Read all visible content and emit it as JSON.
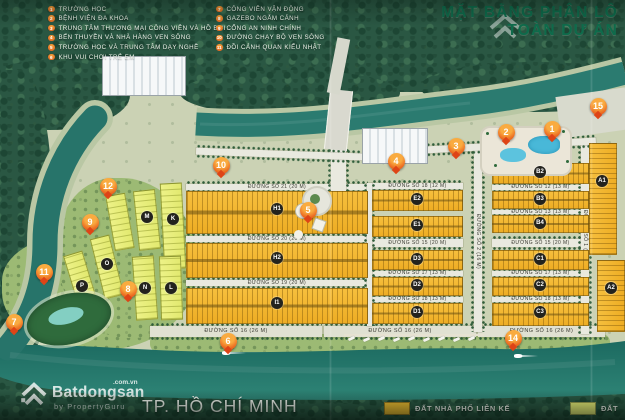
{
  "header": {
    "title_line1": "MẶT BẰNG PHÂN LÔ",
    "title_line2": "TOÀN DỰ ÁN"
  },
  "city_label": "TP. HỒ CHÍ MINH",
  "watermark": {
    "brand": "Batdongsan",
    "suffix": ".com.vn",
    "byline": "by PropertyGuru"
  },
  "legend_top": {
    "col1": [
      {
        "n": "1",
        "label": "TRƯỜNG HỌC"
      },
      {
        "n": "2",
        "label": "BỆNH VIỆN ĐA KHOA"
      },
      {
        "n": "3",
        "label": "TRUNG TÂM THƯƠNG MẠI CÔNG VIÊN VÀ HỒ BƠI"
      },
      {
        "n": "4",
        "label": "BẾN THUYỀN VÀ NHÀ HÀNG VEN SÔNG"
      },
      {
        "n": "5",
        "label": "TRƯỜNG HỌC VÀ TRUNG TÂM DẠY NGHỀ"
      },
      {
        "n": "6",
        "label": "KHU VUI CHƠI TRẺ EM"
      }
    ],
    "col2": [
      {
        "n": "7",
        "label": "CÔNG VIÊN VẬN ĐỘNG"
      },
      {
        "n": "8",
        "label": "GAZEBO NGẮM CẢNH"
      },
      {
        "n": "9",
        "label": "CỔNG AN NINH CHÍNH"
      },
      {
        "n": "10",
        "label": "ĐƯỜNG CHẠY BỘ VEN SÔNG"
      },
      {
        "n": "11",
        "label": "ĐỒI CẢNH QUAN KIỂU NHẬT"
      }
    ]
  },
  "legend_bottom": [
    {
      "label": "ĐẤT NHÀ PHỐ LIÊN KẾ",
      "color": "#f0be31"
    },
    {
      "label": "ĐẤT",
      "color": "#ecf178"
    }
  ],
  "colors": {
    "title_green": "#0e6b4b",
    "marker_orange": "#e8601e",
    "townhouse_lot": "#f0b42d",
    "villa_lot": "#e9ee7d",
    "river": "#26766c"
  },
  "map": {
    "markers": [
      {
        "n": "1",
        "x": 552,
        "y": 129
      },
      {
        "n": "2",
        "x": 506,
        "y": 132
      },
      {
        "n": "3",
        "x": 456,
        "y": 146
      },
      {
        "n": "4",
        "x": 396,
        "y": 161
      },
      {
        "n": "5",
        "x": 308,
        "y": 210
      },
      {
        "n": "6",
        "x": 228,
        "y": 341
      },
      {
        "n": "7",
        "x": 14,
        "y": 322
      },
      {
        "n": "8",
        "x": 128,
        "y": 289
      },
      {
        "n": "9",
        "x": 90,
        "y": 222
      },
      {
        "n": "10",
        "x": 221,
        "y": 165
      },
      {
        "n": "11",
        "x": 44,
        "y": 272
      },
      {
        "n": "12",
        "x": 108,
        "y": 186
      },
      {
        "n": "14",
        "x": 513,
        "y": 338
      },
      {
        "n": "15",
        "x": 598,
        "y": 106
      }
    ],
    "blocks": [
      {
        "label": "H1",
        "x": 186,
        "y": 191,
        "w": 182,
        "h": 43,
        "kind": "row"
      },
      {
        "label": "H2",
        "x": 186,
        "y": 243,
        "w": 182,
        "h": 35,
        "kind": "row"
      },
      {
        "label": "I1",
        "x": 186,
        "y": 288,
        "w": 182,
        "h": 36,
        "kind": "row"
      },
      {
        "label": "E2",
        "x": 372,
        "y": 190,
        "w": 91,
        "h": 21,
        "kind": "row"
      },
      {
        "label": "E1",
        "x": 372,
        "y": 216,
        "w": 91,
        "h": 21,
        "kind": "row"
      },
      {
        "label": "D3",
        "x": 372,
        "y": 250,
        "w": 91,
        "h": 20,
        "kind": "row"
      },
      {
        "label": "D2",
        "x": 372,
        "y": 277,
        "w": 91,
        "h": 19,
        "kind": "row"
      },
      {
        "label": "D1",
        "x": 372,
        "y": 303,
        "w": 91,
        "h": 21,
        "kind": "row"
      },
      {
        "label": "B2",
        "x": 492,
        "y": 163,
        "w": 97,
        "h": 21,
        "kind": "row"
      },
      {
        "label": "B3",
        "x": 492,
        "y": 191,
        "w": 97,
        "h": 18,
        "kind": "row"
      },
      {
        "label": "B4",
        "x": 492,
        "y": 215,
        "w": 97,
        "h": 18,
        "kind": "row"
      },
      {
        "label": "C1",
        "x": 492,
        "y": 250,
        "w": 97,
        "h": 20,
        "kind": "row"
      },
      {
        "label": "C2",
        "x": 492,
        "y": 277,
        "w": 97,
        "h": 19,
        "kind": "row"
      },
      {
        "label": "C3",
        "x": 492,
        "y": 303,
        "w": 97,
        "h": 23,
        "kind": "row"
      },
      {
        "label": "A1",
        "x": 589,
        "y": 143,
        "w": 28,
        "h": 112,
        "kind": "col"
      },
      {
        "label": "A2",
        "x": 597,
        "y": 260,
        "w": 28,
        "h": 72,
        "kind": "col"
      },
      {
        "label": "K",
        "x": 162,
        "y": 183,
        "w": 22,
        "h": 86,
        "kind": "villa",
        "rot": -3
      },
      {
        "label": "M",
        "x": 136,
        "y": 190,
        "w": 22,
        "h": 60,
        "kind": "villa",
        "rot": -6
      },
      {
        "label": "",
        "x": 110,
        "y": 194,
        "w": 20,
        "h": 56,
        "kind": "villa",
        "rot": -10
      },
      {
        "label": "O",
        "x": 97,
        "y": 236,
        "w": 20,
        "h": 62,
        "kind": "villa",
        "rot": -14
      },
      {
        "label": "P",
        "x": 72,
        "y": 252,
        "w": 20,
        "h": 64,
        "kind": "villa",
        "rot": -17
      },
      {
        "label": "N",
        "x": 134,
        "y": 256,
        "w": 22,
        "h": 64,
        "kind": "villa",
        "rot": -4
      },
      {
        "label": "L",
        "x": 160,
        "y": 256,
        "w": 22,
        "h": 64,
        "kind": "villa",
        "rot": -2
      }
    ],
    "chips": [
      {
        "label": "H1",
        "x": 277,
        "y": 209
      },
      {
        "label": "H2",
        "x": 277,
        "y": 258
      },
      {
        "label": "I1",
        "x": 277,
        "y": 303
      },
      {
        "label": "E2",
        "x": 417,
        "y": 199
      },
      {
        "label": "E1",
        "x": 417,
        "y": 225
      },
      {
        "label": "D3",
        "x": 417,
        "y": 259
      },
      {
        "label": "D2",
        "x": 417,
        "y": 285
      },
      {
        "label": "D1",
        "x": 417,
        "y": 312
      },
      {
        "label": "B2",
        "x": 540,
        "y": 172
      },
      {
        "label": "B3",
        "x": 540,
        "y": 199
      },
      {
        "label": "B4",
        "x": 540,
        "y": 223
      },
      {
        "label": "C1",
        "x": 540,
        "y": 259
      },
      {
        "label": "C2",
        "x": 540,
        "y": 285
      },
      {
        "label": "C3",
        "x": 540,
        "y": 312
      },
      {
        "label": "A1",
        "x": 602,
        "y": 181
      },
      {
        "label": "A2",
        "x": 611,
        "y": 288
      },
      {
        "label": "K",
        "x": 173,
        "y": 219
      },
      {
        "label": "M",
        "x": 147,
        "y": 217
      },
      {
        "label": "O",
        "x": 107,
        "y": 264
      },
      {
        "label": "P",
        "x": 82,
        "y": 286
      },
      {
        "label": "N",
        "x": 145,
        "y": 288
      },
      {
        "label": "L",
        "x": 171,
        "y": 288
      }
    ],
    "streets": [
      {
        "label": "ĐƯỜNG SỐ 21 (20 M)",
        "x": 186,
        "y": 184,
        "w": 182,
        "h": 6
      },
      {
        "label": "ĐƯỜNG SỐ 20 (20 M)",
        "x": 186,
        "y": 236,
        "w": 182,
        "h": 6
      },
      {
        "label": "ĐƯỜNG SỐ 19 (20 M)",
        "x": 186,
        "y": 280,
        "w": 182,
        "h": 6
      },
      {
        "label": "ĐƯỜNG SỐ 18 (12 M)",
        "x": 372,
        "y": 183,
        "w": 91,
        "h": 6
      },
      {
        "label": "ĐƯỜNG SỐ 15 (20 M)",
        "x": 372,
        "y": 239,
        "w": 91,
        "h": 8
      },
      {
        "label": "ĐƯỜNG SỐ 15 (20 M)",
        "x": 492,
        "y": 239,
        "w": 97,
        "h": 8
      },
      {
        "label": "ĐƯỜNG SỐ 17 (13 M)",
        "x": 372,
        "y": 271,
        "w": 91,
        "h": 5
      },
      {
        "label": "ĐƯỜNG SỐ 18 (13 M)",
        "x": 372,
        "y": 297,
        "w": 91,
        "h": 5
      },
      {
        "label": "ĐƯỜNG SỐ 12 (13 M)",
        "x": 492,
        "y": 185,
        "w": 97,
        "h": 5
      },
      {
        "label": "ĐƯỜNG SỐ 13 (13 M)",
        "x": 492,
        "y": 210,
        "w": 97,
        "h": 4
      },
      {
        "label": "ĐƯỜNG SỐ 17 (13 M)",
        "x": 492,
        "y": 271,
        "w": 97,
        "h": 5
      },
      {
        "label": "ĐƯỜNG SỐ 18 (13 M)",
        "x": 492,
        "y": 297,
        "w": 97,
        "h": 5
      },
      {
        "label": "ĐƯỜNG SỐ 16 (26 M)",
        "x": 150,
        "y": 326,
        "w": 172,
        "h": 11,
        "cls": "blvd"
      },
      {
        "label": "ĐƯỜNG SỐ 16 (26 M)",
        "x": 324,
        "y": 326,
        "w": 152,
        "h": 11,
        "cls": "blvd"
      },
      {
        "label": "ĐƯỜNG SỐ 16 (26 M)",
        "x": 478,
        "y": 326,
        "w": 127,
        "h": 11,
        "cls": "blvd"
      },
      {
        "label": "",
        "x": 367,
        "y": 183,
        "w": 5,
        "h": 143,
        "v": true
      },
      {
        "label": "ĐƯỜNG SỐ 2 (16 M)",
        "x": 474,
        "y": 150,
        "w": 8,
        "h": 182,
        "v": true
      },
      {
        "label": "ĐƯỜNG SỐ 1 (16 M)",
        "x": 581,
        "y": 140,
        "w": 8,
        "h": 194,
        "v": true
      },
      {
        "label": "",
        "x": 331,
        "y": 148,
        "w": 15,
        "h": 44,
        "v": true
      },
      {
        "label": "",
        "x": 196,
        "y": 151,
        "w": 190,
        "h": 7,
        "rot": 2
      },
      {
        "label": "",
        "x": 386,
        "y": 143,
        "w": 210,
        "h": 7,
        "rot": -3
      }
    ]
  }
}
